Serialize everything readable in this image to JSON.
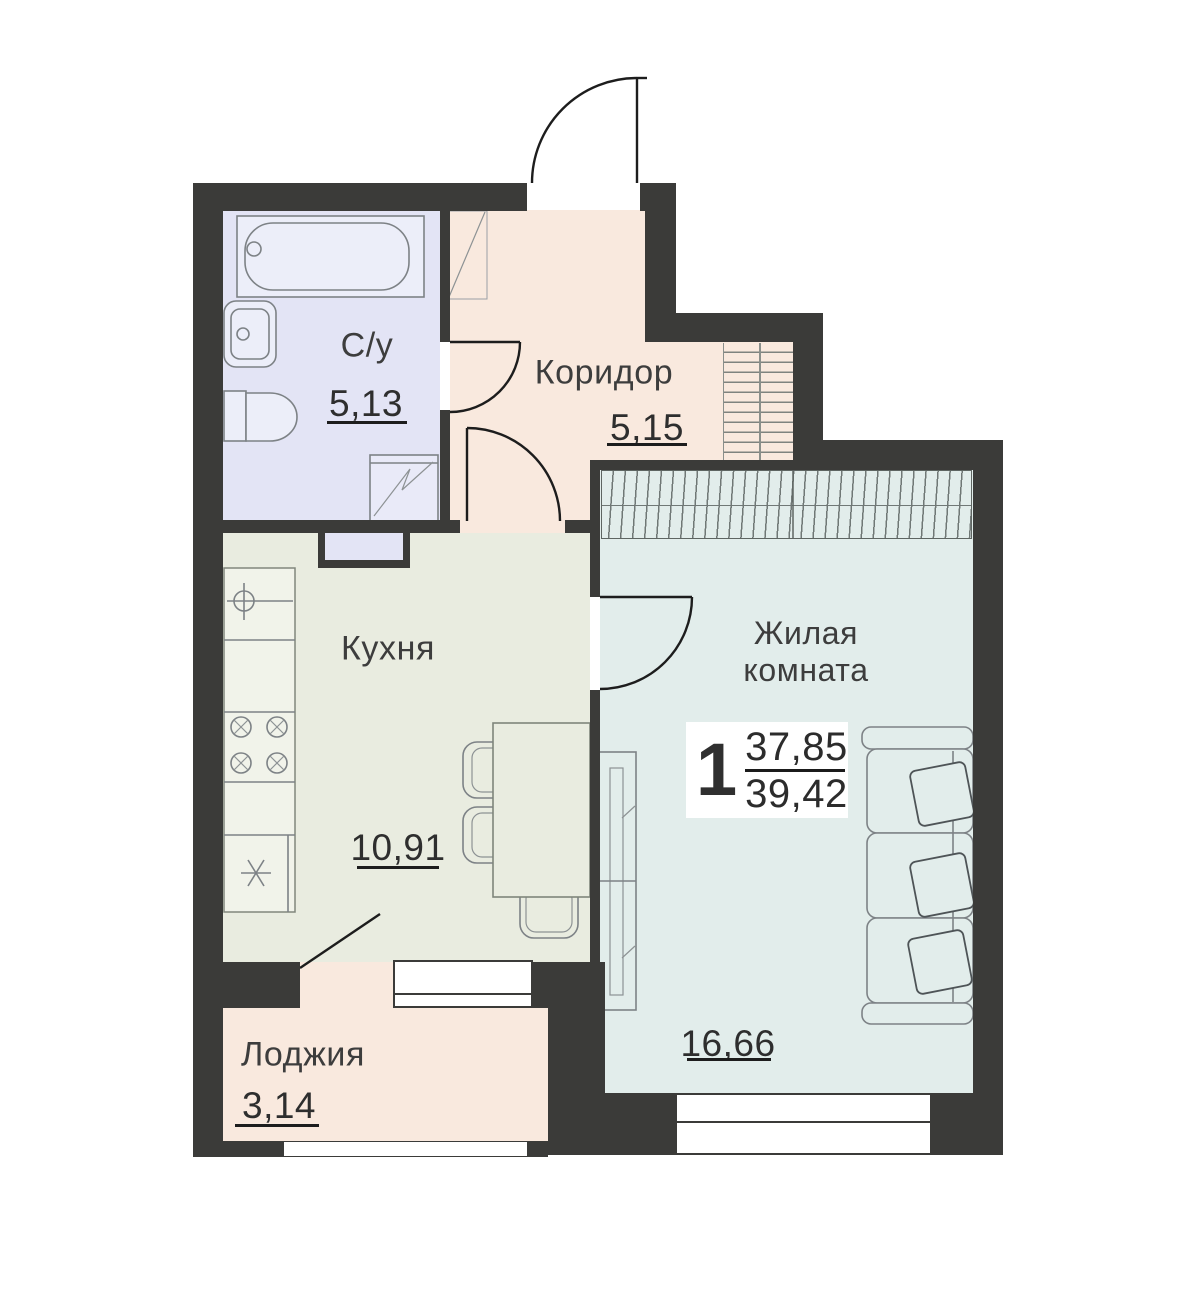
{
  "colors": {
    "wall": "#3b3b39",
    "bathroom-fill": "#e3e4f5",
    "corridor-fill": "#f9e9de",
    "kitchen-fill": "#e9ece0",
    "living-fill": "#e2edeb",
    "loggia-fill": "#f9e9de",
    "underline": "#1d1d1d",
    "furniture-stroke": "#7d8286",
    "text": "#3d3d3d"
  },
  "rooms": [
    {
      "id": "bathroom",
      "label": "С/у",
      "area": "5,13"
    },
    {
      "id": "corridor",
      "label": "Коридор",
      "area": "5,15"
    },
    {
      "id": "kitchen",
      "label": "Кухня",
      "area": "10,91"
    },
    {
      "id": "living",
      "label": "Жилая комната",
      "label_lines": [
        "Жилая",
        "комната"
      ],
      "area": "16,66"
    },
    {
      "id": "loggia",
      "label": "Лоджия",
      "area": "3,14"
    }
  ],
  "summary": {
    "rooms_count": "1",
    "living_area": "37,85",
    "total_area": "39,42"
  }
}
